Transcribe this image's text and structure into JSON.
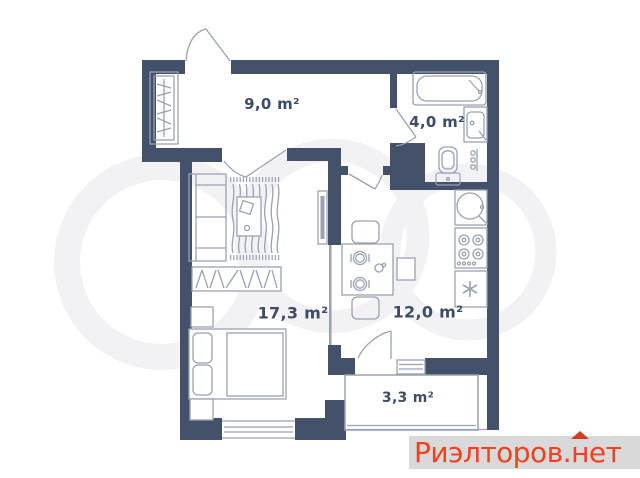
{
  "plan": {
    "rooms": [
      {
        "id": "hallway",
        "area_label": "9,0 m²"
      },
      {
        "id": "bathroom",
        "area_label": "4,0 m²"
      },
      {
        "id": "living_room",
        "area_label": "17,3 m²"
      },
      {
        "id": "kitchen",
        "area_label": "12,0 m²"
      },
      {
        "id": "balcony",
        "area_label": "3,3 m²"
      }
    ],
    "colors": {
      "wall": "#44516a",
      "furniture_line": "#99a1b2",
      "label_text": "#3e4c66",
      "background": "#ffffff"
    }
  },
  "branding": {
    "site_watermark": {
      "text_full": "Риэлторов.нет",
      "text_prefix": "Риэлторов.",
      "roof_letter": "н",
      "text_suffix": "ет",
      "text_color": "#f2411f",
      "roof_color": "#d63a1f",
      "strip_background": "#d9d9d9"
    }
  }
}
